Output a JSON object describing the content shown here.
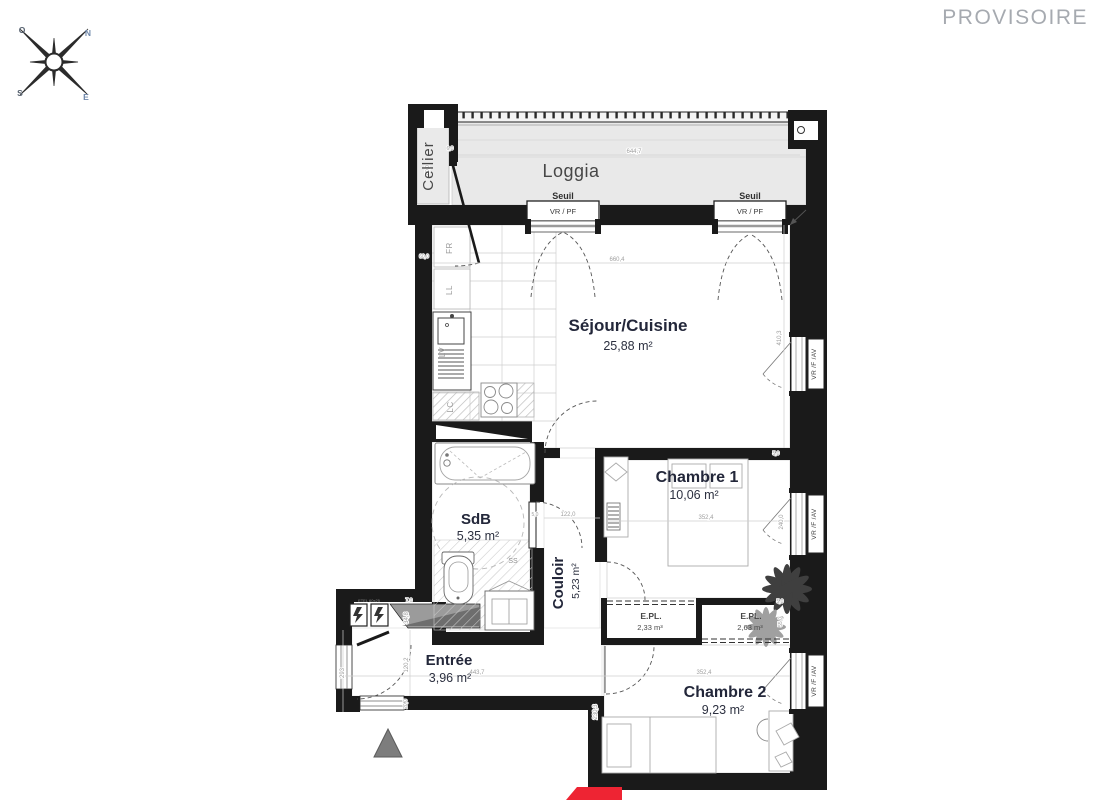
{
  "watermark": {
    "label": "PROVISOIRE"
  },
  "compass": {
    "n": "N",
    "o": "O",
    "s": "S",
    "e": "E"
  },
  "rooms": {
    "cellier": {
      "name": "Cellier"
    },
    "loggia": {
      "name": "Loggia"
    },
    "sejour": {
      "name": "Séjour/Cuisine",
      "area": "25,88 m²"
    },
    "chambre1": {
      "name": "Chambre 1",
      "area": "10,06 m²"
    },
    "sdb": {
      "name": "SdB",
      "area": "5,35 m²"
    },
    "couloir": {
      "name": "Couloir",
      "area": "5,23 m²"
    },
    "entree": {
      "name": "Entrée",
      "area": "3,96 m²"
    },
    "chambre2": {
      "name": "Chambre 2",
      "area": "9,23 m²"
    },
    "placard_left": {
      "name": "E.PL.",
      "volume": "2,33 m³"
    },
    "placard_right": {
      "name": "E.PL.",
      "volume": "2,63 m³"
    }
  },
  "openings": {
    "seuil": "Seuil",
    "vr_pf": "VR / PF",
    "vr_f_av": "VR /F /AV"
  },
  "kitchen": {
    "fridge": "FR",
    "washer": "LL",
    "dishwasher": "LV",
    "lc": "LC"
  },
  "bathroom": {
    "drain": "SS"
  },
  "electrical": {
    "label": "ETEL 60x25"
  },
  "dims": {
    "loggia_w": "644,7",
    "sejour_w": "660,4",
    "sejour_h": "410,3",
    "chambre_w": "352,4",
    "chambre1_h": "240,0",
    "chambre2_h": "230,3",
    "couloir_w": "122,0",
    "entree_w": "443,7",
    "entree_h": "120,2",
    "left_293": "293",
    "wall_348": "34,8",
    "d20": "20,0",
    "d7": "7,0",
    "d6": "6,0",
    "d60": "60,0",
    "d5": "5,0",
    "d55": "55,0"
  },
  "colors": {
    "wall": "#1a1a1a",
    "loggia_fill": "#e9e9e9",
    "accent_red": "#ee2433",
    "label_ink": "#23273a",
    "dim_gray": "#9f9f9f"
  }
}
